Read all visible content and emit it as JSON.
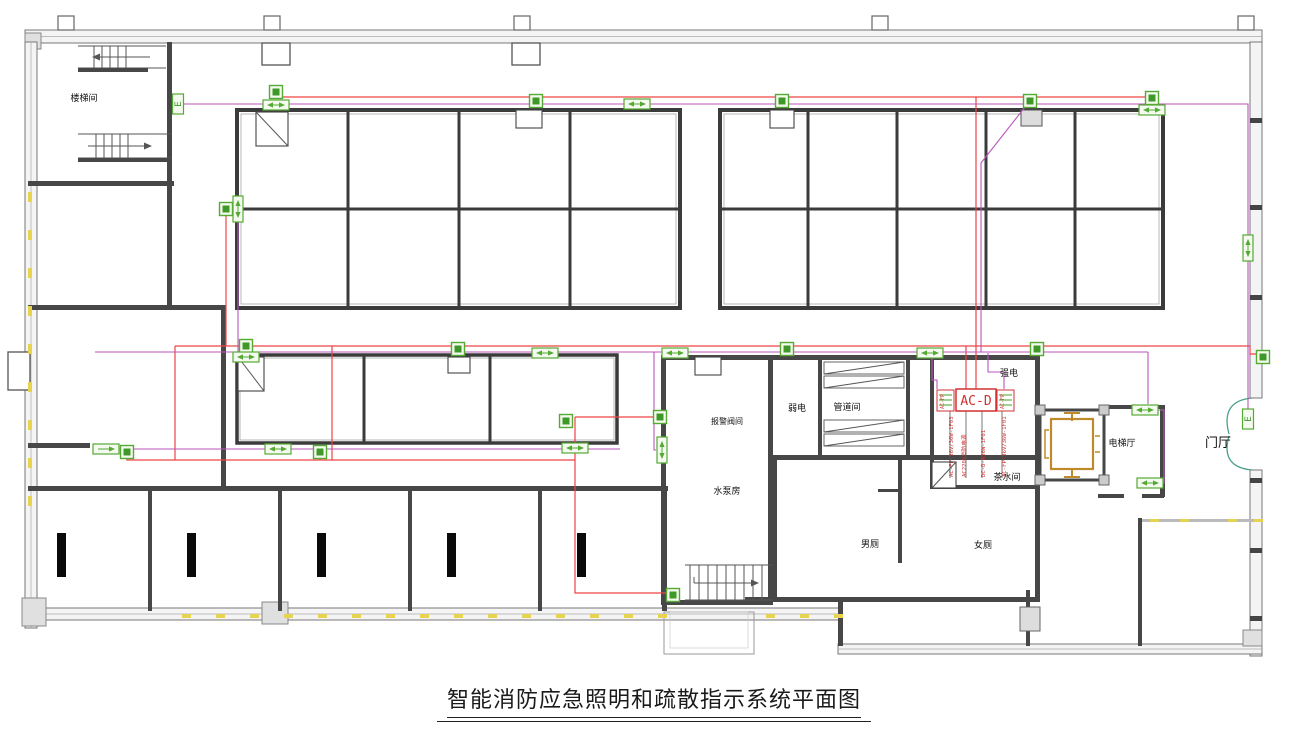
{
  "title": {
    "text": "智能消防应急照明和疏散指示系统平面图"
  },
  "colors": {
    "wire_red": "#ee4444",
    "wire_magenta": "#bb55bb",
    "device_green": "#55aa33",
    "device_green_dark": "#3f9928",
    "wall_dark": "#474747",
    "elevator_orange": "#bf8a2a",
    "door_teal": "#49a08e",
    "window_yellow": "#e6d34f",
    "panel_red": "#d03030"
  },
  "device_types": {
    "light": "emergency-ceiling-light",
    "exith": "exit-indicator-horizontal",
    "exitv": "exit-indicator-vertical",
    "ebox": "emergency-lamp-e"
  },
  "ebox_letter": "E",
  "room_labels": [
    {
      "id": "stairwell",
      "text": "楼梯间",
      "x": 84,
      "y": 101,
      "size": 9
    },
    {
      "id": "alarm-valve-room",
      "text": "报警阀间",
      "x": 727,
      "y": 424,
      "size": 8
    },
    {
      "id": "pump-room",
      "text": "水泵房",
      "x": 727,
      "y": 494,
      "size": 9
    },
    {
      "id": "weak-electric-room",
      "text": "弱电",
      "x": 797,
      "y": 411,
      "size": 9
    },
    {
      "id": "pipe-room",
      "text": "管道间",
      "x": 847,
      "y": 410,
      "size": 9
    },
    {
      "id": "strong-electric-room",
      "text": "强电",
      "x": 1009,
      "y": 376,
      "size": 9
    },
    {
      "id": "pantry",
      "text": "茶水间",
      "x": 1007,
      "y": 480,
      "size": 9
    },
    {
      "id": "mens-toilet",
      "text": "男厕",
      "x": 870,
      "y": 547,
      "size": 9
    },
    {
      "id": "womens-toilet",
      "text": "女厕",
      "x": 983,
      "y": 548,
      "size": 9
    },
    {
      "id": "elevator-hall",
      "text": "电梯厅",
      "x": 1122,
      "y": 446,
      "size": 9
    },
    {
      "id": "foyer",
      "text": "门厅",
      "x": 1218,
      "y": 447,
      "size": 13
    }
  ],
  "panel": {
    "label": "AC-D",
    "x": 956,
    "y": 389,
    "w": 40,
    "h": 22,
    "side_label_left": "AC-FP",
    "side_label_right": "AC-FP"
  },
  "circuit_labels": [
    {
      "text": "AC-FP-36V/36W-1F03",
      "x": 953,
      "y": 477
    },
    {
      "text": "AC220V消防电源",
      "x": 966,
      "y": 477
    },
    {
      "text": "DC-D-N36W-1F01",
      "x": 985,
      "y": 477
    },
    {
      "text": "AC-FP-36V/36W-1F01",
      "x": 1006,
      "y": 477
    }
  ],
  "devices": [
    {
      "type": "light",
      "x": 276,
      "y": 92
    },
    {
      "type": "exith",
      "x": 276,
      "y": 105
    },
    {
      "type": "ebox",
      "x": 178,
      "y": 104
    },
    {
      "type": "light",
      "x": 536,
      "y": 101
    },
    {
      "type": "exith",
      "x": 637,
      "y": 104
    },
    {
      "type": "light",
      "x": 782,
      "y": 101
    },
    {
      "type": "light",
      "x": 1030,
      "y": 101
    },
    {
      "type": "light",
      "x": 1152,
      "y": 98
    },
    {
      "type": "exith",
      "x": 1152,
      "y": 110
    },
    {
      "type": "exitv",
      "x": 1248,
      "y": 248
    },
    {
      "type": "light",
      "x": 1263,
      "y": 357
    },
    {
      "type": "ebox",
      "x": 1248,
      "y": 419
    },
    {
      "type": "light",
      "x": 226,
      "y": 209
    },
    {
      "type": "exitv",
      "x": 238,
      "y": 209
    },
    {
      "type": "light",
      "x": 246,
      "y": 346
    },
    {
      "type": "exith",
      "x": 246,
      "y": 357
    },
    {
      "type": "light",
      "x": 458,
      "y": 349
    },
    {
      "type": "exith",
      "x": 545,
      "y": 353
    },
    {
      "type": "exith",
      "x": 675,
      "y": 353
    },
    {
      "type": "light",
      "x": 787,
      "y": 349
    },
    {
      "type": "exith",
      "x": 930,
      "y": 353
    },
    {
      "type": "light",
      "x": 1037,
      "y": 349
    },
    {
      "type": "exith",
      "x": 1145,
      "y": 410
    },
    {
      "type": "exith",
      "x": 1150,
      "y": 483
    },
    {
      "type": "light",
      "x": 660,
      "y": 417
    },
    {
      "type": "exitv",
      "x": 662,
      "y": 450
    },
    {
      "type": "exith",
      "x": 106,
      "y": 449,
      "dir": "r"
    },
    {
      "type": "light",
      "x": 127,
      "y": 452
    },
    {
      "type": "exith",
      "x": 278,
      "y": 449
    },
    {
      "type": "light",
      "x": 320,
      "y": 452
    },
    {
      "type": "light",
      "x": 566,
      "y": 421
    },
    {
      "type": "exith",
      "x": 575,
      "y": 448
    },
    {
      "type": "light",
      "x": 673,
      "y": 595
    }
  ],
  "wires": {
    "red": [
      "M276,92 V97 H1152 V102",
      "M536,97 V100",
      "M782,97 V100",
      "M1030,97 V100",
      "M976,97 V389",
      "M966,346 V389",
      "M175,346 H1250 V354 H1258",
      "M458,346 V349",
      "M787,346 V349",
      "M1037,346 V349",
      "M226,216 V346",
      "M175,346 V460",
      "M127,452 V460 H575",
      "M320,452 V460",
      "M332,346 V460",
      "M575,417 H654",
      "M575,417 V593 H666"
    ],
    "magenta": [
      "M183,104 H1248 V412",
      "M95,352 H1148",
      "M238,216 V352",
      "M1148,352 V404",
      "M1157,410 H1164 V483 H1158",
      "M1025,107 L981,163 V352",
      "M932,353 V380 H937 V389",
      "M988,353 V372 H1004 V389",
      "M95,449 H620",
      "M654,352 V450 H656"
    ],
    "leaders": [
      "M950,411 V478",
      "M966,411 V478",
      "M982,411 V478",
      "M1002,411 V478"
    ]
  },
  "window_ticks": {
    "left_x": 28,
    "left_ys": [
      192,
      230,
      268,
      306,
      344,
      382,
      420,
      458,
      496
    ],
    "bottom_y": 614,
    "bottom_xs": [
      182,
      216,
      250,
      284,
      318,
      352,
      386,
      420,
      454,
      488,
      522,
      556,
      590,
      624,
      658,
      766,
      800,
      834
    ],
    "right_y": 519,
    "right_xs": [
      1150,
      1180,
      1228,
      1254
    ]
  }
}
